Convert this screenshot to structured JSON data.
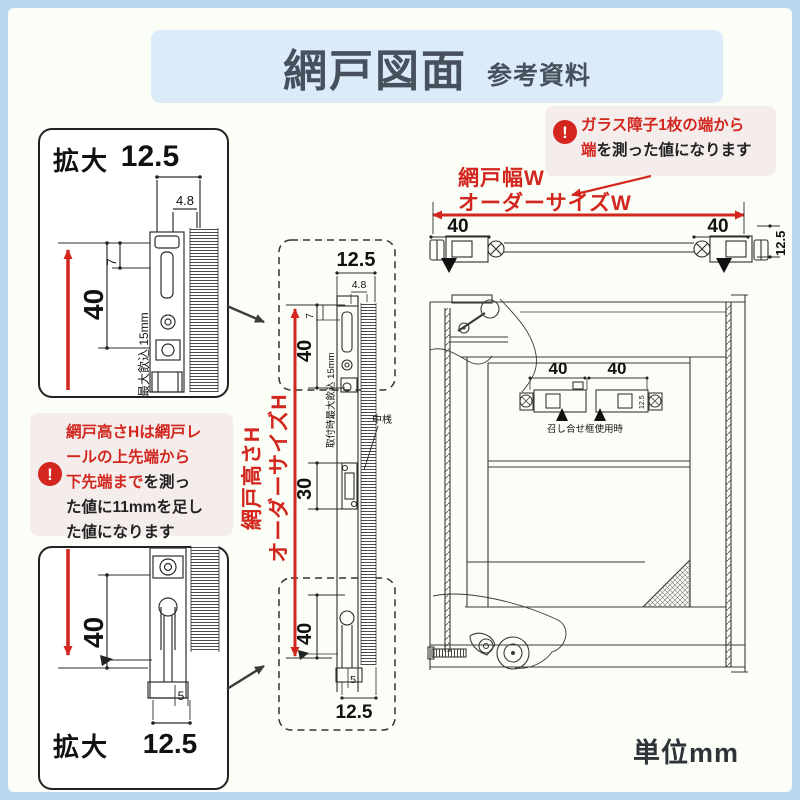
{
  "colors": {
    "accent_red": "#d2261e",
    "outer_border_blue": "#b9d8ee",
    "title_banner_blue": "#dcebf8",
    "callout_pink": "#f4edec",
    "ink": "#2f2f2f"
  },
  "header": {
    "title": "網戸図面",
    "subtitle": "参考資料"
  },
  "unit_note": "単位mm",
  "callout_width": {
    "alert_icon": "!",
    "l1_red": "ガラス障子1枚の端から",
    "l2_red": "端",
    "l2_black": "を測った値になります"
  },
  "callout_height": {
    "alert_icon": "!",
    "l1_red": "網戸高さHは網戸レ",
    "l2_red": "ールの上先端から",
    "l3_red": "下先端まで",
    "l3_black": "を測っ",
    "l4_black": "た値に11mmを足し",
    "l5_black": "た値になります"
  },
  "width_label": {
    "line1": "網戸幅W",
    "line2": "オーダーサイズW"
  },
  "height_label": {
    "line1": "網戸高さH",
    "line2": "オーダーサイズH"
  },
  "zoom_boxes": {
    "top_label": "拡大",
    "bottom_label": "拡大"
  },
  "annotations": {
    "middle_rail": "中桟",
    "meeting_stile": "召し合せ框使用時",
    "max_engage_top": "最大飲込 15mm",
    "max_engage_mid": "取付時最大飲込 15mm"
  },
  "dims": {
    "tl": {
      "w": "12.5",
      "a": "4.8",
      "b": "7",
      "h": "40"
    },
    "bl": {
      "h": "40",
      "gap": "5",
      "w": "12.5"
    },
    "mt": {
      "w": "12.5",
      "a": "4.8",
      "b": "7",
      "h": "40"
    },
    "mc": {
      "rail": "30"
    },
    "mb": {
      "h": "40",
      "gap": "5",
      "w": "12.5"
    },
    "wsec": {
      "left": "40",
      "right": "40",
      "depth": "12.5"
    },
    "stile": {
      "left": "40",
      "right": "40",
      "depth": "12.5"
    }
  }
}
